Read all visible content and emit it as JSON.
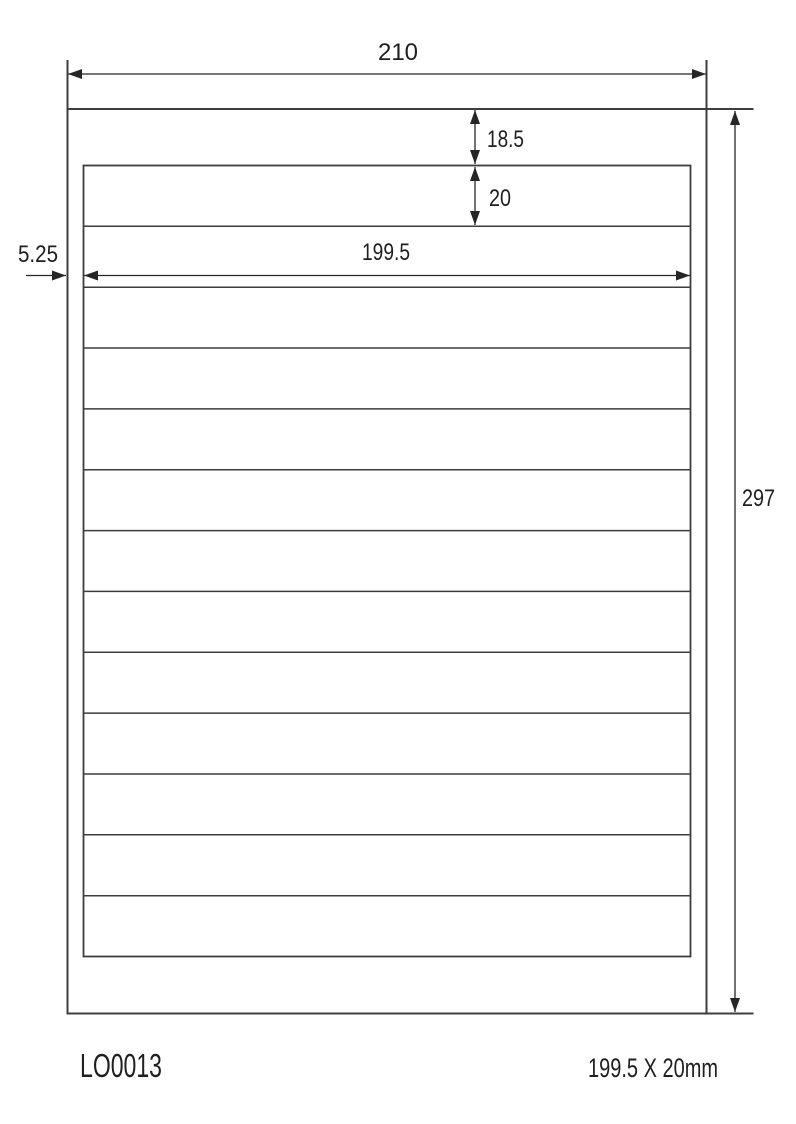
{
  "diagram": {
    "dimensions": {
      "page_width_mm": "210",
      "page_height_mm": "297",
      "top_margin_mm": "18.5",
      "label_height_mm": "20",
      "label_width_mm": "199.5",
      "side_margin_mm": "5.25"
    },
    "label_grid": {
      "rows": 13,
      "columns": 1
    },
    "colors": {
      "border_line": "#3d3d3d",
      "dimension_line": "#262626",
      "text": "#1f1f1f",
      "background": "#ffffff"
    }
  },
  "footer": {
    "product_code": "LO0013",
    "label_size_text": "199.5 X 20mm"
  }
}
